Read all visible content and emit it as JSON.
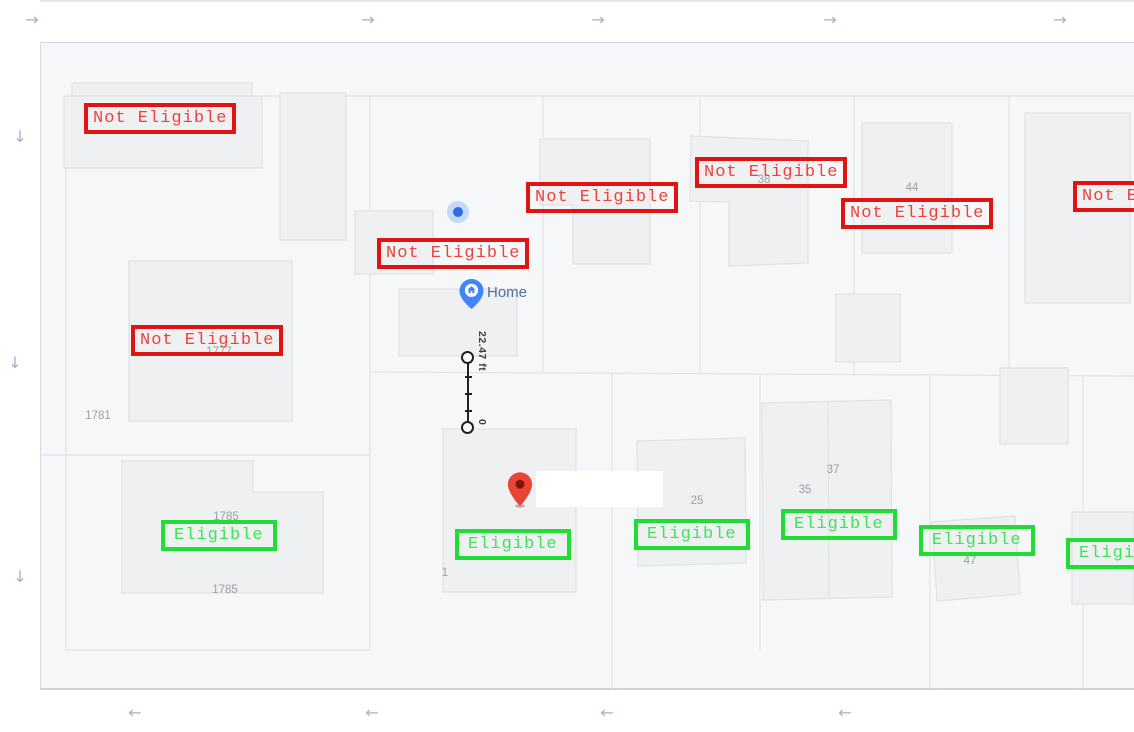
{
  "labels": {
    "not_eligible": "Not Eligible",
    "eligible": "Eligible"
  },
  "home": {
    "label": "Home"
  },
  "measurement": {
    "distance": "22.47 ft",
    "start": "0"
  },
  "annotations": {
    "red_boxes": [
      {
        "x": 84,
        "y": 103
      },
      {
        "x": 526,
        "y": 182
      },
      {
        "x": 695,
        "y": 157
      },
      {
        "x": 841,
        "y": 198
      },
      {
        "x": 1073,
        "y": 181
      },
      {
        "x": 377,
        "y": 238
      },
      {
        "x": 131,
        "y": 325
      }
    ],
    "green_boxes": [
      {
        "x": 161,
        "y": 520
      },
      {
        "x": 455,
        "y": 529
      },
      {
        "x": 634,
        "y": 519
      },
      {
        "x": 781,
        "y": 509
      },
      {
        "x": 919,
        "y": 525
      },
      {
        "x": 1066,
        "y": 538
      }
    ]
  },
  "parcel_numbers": [
    {
      "text": "1781",
      "x": 98,
      "y": 416
    },
    {
      "text": "1777",
      "x": 219,
      "y": 352
    },
    {
      "text": "1785",
      "x": 226,
      "y": 517
    },
    {
      "text": "1785",
      "x": 225,
      "y": 590
    },
    {
      "text": "1",
      "x": 445,
      "y": 573
    },
    {
      "text": "25",
      "x": 697,
      "y": 501
    },
    {
      "text": "35",
      "x": 805,
      "y": 490
    },
    {
      "text": "37",
      "x": 833,
      "y": 470
    },
    {
      "text": "38",
      "x": 764,
      "y": 180
    },
    {
      "text": "44",
      "x": 912,
      "y": 188
    },
    {
      "text": "47",
      "x": 970,
      "y": 561
    }
  ],
  "map_geometry": {
    "parcel_lines": [
      [
        66,
        96,
        1134,
        96
      ],
      [
        66,
        96,
        66,
        650
      ],
      [
        370,
        96,
        370,
        650
      ],
      [
        543,
        96,
        543,
        372
      ],
      [
        700,
        96,
        700,
        373
      ],
      [
        854,
        96,
        854,
        376
      ],
      [
        1009,
        96,
        1009,
        376
      ],
      [
        370,
        372,
        1134,
        376
      ],
      [
        41,
        455,
        370,
        455
      ],
      [
        66,
        650,
        370,
        650
      ],
      [
        612,
        373,
        612,
        689
      ],
      [
        760,
        373,
        760,
        650
      ],
      [
        930,
        376,
        930,
        689
      ],
      [
        1083,
        377,
        1083,
        689
      ]
    ],
    "buildings": [
      [
        [
          72,
          83
        ],
        [
          252,
          83
        ],
        [
          252,
          161
        ],
        [
          72,
          161
        ]
      ],
      [
        [
          64,
          96
        ],
        [
          262,
          96
        ],
        [
          262,
          168
        ],
        [
          64,
          168
        ]
      ],
      [
        [
          280,
          93
        ],
        [
          346,
          93
        ],
        [
          346,
          240
        ],
        [
          280,
          240
        ]
      ],
      [
        [
          355,
          211
        ],
        [
          433,
          211
        ],
        [
          433,
          274
        ],
        [
          355,
          274
        ]
      ],
      [
        [
          399,
          289
        ],
        [
          517,
          289
        ],
        [
          517,
          356
        ],
        [
          399,
          356
        ]
      ],
      [
        [
          540,
          139
        ],
        [
          650,
          139
        ],
        [
          650,
          264
        ],
        [
          573,
          264
        ],
        [
          573,
          205
        ],
        [
          540,
          205
        ]
      ],
      [
        [
          691,
          136
        ],
        [
          808,
          141
        ],
        [
          808,
          263
        ],
        [
          729,
          266
        ],
        [
          729,
          202
        ],
        [
          690,
          201
        ]
      ],
      [
        [
          862,
          123
        ],
        [
          952,
          123
        ],
        [
          952,
          253
        ],
        [
          862,
          253
        ]
      ],
      [
        [
          1025,
          113
        ],
        [
          1130,
          113
        ],
        [
          1130,
          303
        ],
        [
          1025,
          303
        ]
      ],
      [
        [
          836,
          294
        ],
        [
          900,
          294
        ],
        [
          900,
          362
        ],
        [
          836,
          362
        ]
      ],
      [
        [
          1000,
          368
        ],
        [
          1068,
          368
        ],
        [
          1068,
          444
        ],
        [
          1000,
          444
        ]
      ],
      [
        [
          443,
          429
        ],
        [
          576,
          429
        ],
        [
          576,
          592
        ],
        [
          443,
          592
        ]
      ],
      [
        [
          637,
          441
        ],
        [
          745,
          438
        ],
        [
          746,
          563
        ],
        [
          638,
          566
        ]
      ],
      [
        [
          762,
          403
        ],
        [
          891,
          400
        ],
        [
          892,
          597
        ],
        [
          763,
          600
        ]
      ],
      [
        [
          932,
          522
        ],
        [
          1015,
          516
        ],
        [
          1020,
          594
        ],
        [
          937,
          601
        ]
      ],
      [
        [
          1072,
          512
        ],
        [
          1134,
          512
        ],
        [
          1134,
          604
        ],
        [
          1072,
          604
        ]
      ],
      [
        [
          122,
          461
        ],
        [
          253,
          461
        ],
        [
          253,
          492
        ],
        [
          323,
          492
        ],
        [
          323,
          593
        ],
        [
          122,
          593
        ]
      ],
      [
        [
          129,
          261
        ],
        [
          292,
          261
        ],
        [
          292,
          421
        ],
        [
          129,
          421
        ]
      ]
    ],
    "building_dividers": [
      [
        828,
        401,
        829,
        598
      ]
    ]
  },
  "scroll_arrows": {
    "top": [
      {
        "x": 32,
        "y": 20
      },
      {
        "x": 368,
        "y": 20
      },
      {
        "x": 598,
        "y": 20
      },
      {
        "x": 830,
        "y": 20
      },
      {
        "x": 1060,
        "y": 20
      }
    ],
    "left": [
      {
        "x": 20,
        "y": 137
      },
      {
        "x": 15,
        "y": 363
      },
      {
        "x": 20,
        "y": 577
      }
    ],
    "bottom": [
      {
        "x": 135,
        "y": 713
      },
      {
        "x": 372,
        "y": 713
      },
      {
        "x": 607,
        "y": 713
      },
      {
        "x": 845,
        "y": 713
      }
    ]
  },
  "colors": {
    "map_bg": "#f6f7f9",
    "map_border": "#d8d9df",
    "building_fill": "#eef0f2",
    "building_stroke": "#e0e2e7",
    "parcel_line": "#e1e3e8",
    "parcel_number": "#9aa0a6",
    "not_eligible": "#e01513",
    "not_eligible_text": "#ef423c",
    "eligible": "#1fdd33",
    "eligible_text": "#3fe358",
    "arrow": "#a8aecb",
    "home_pin": "#4285f4",
    "home_text": "#566d9e",
    "red_pin": "#e94335",
    "red_pin_inner": "#7f1408",
    "blue_dot": "#2f6ce0",
    "blue_dot_halo": "#c5d8f9",
    "measure": "#202124"
  }
}
